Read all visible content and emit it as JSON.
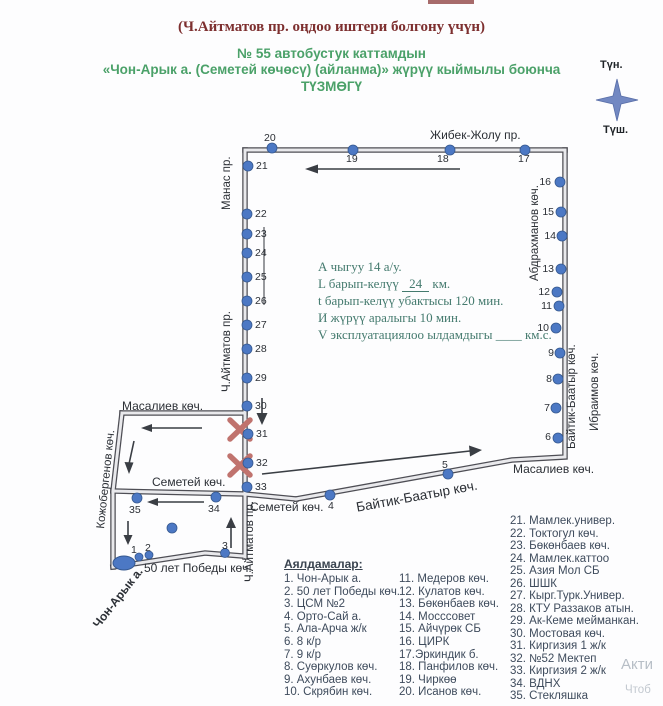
{
  "header": {
    "line1": "(Ч.Айтматов пр. оңдоо иштери болгону үчүн)",
    "line2": "№ 55  автобустук каттамдын",
    "line3": "«Чон-Арык а. (Семетей көчөсү) (айланма)»  жүрүү кыймылы боюнча",
    "line4": "ТҮЗМӨГҮ"
  },
  "compass": {
    "north": "Түн.",
    "south": "Түш."
  },
  "info": {
    "line1": "А чыгуу 14 а/у.",
    "line2_prefix": "L барып-келүү",
    "line2_value": "24",
    "line2_suffix": "км.",
    "line3": "t барып-келүү убактысы 120 мин.",
    "line4": "И жүрүү аралыгы  10  мин.",
    "line5_prefix": "V эксплуатациялоо ылдамдыгы",
    "line5_blank": "____",
    "line5_suffix": "км.с."
  },
  "streets": {
    "zhibek_zholu": "Жибек-Жолу пр.",
    "manas": "Манас пр.",
    "aitmatov": "Ч.Айтматов пр.",
    "abdrakhmanov": "Абдрахманов көч.",
    "baitik_baatyr": "Байтик-Баатыр көч.",
    "ibraimov": "Ибраимов көч.",
    "masaliev": "Масалиев  көч.",
    "kozhobergenov": "Кожобергенов көч.",
    "semetei": "Семетей  көч.",
    "pobedy": "50 лет Победы көч.",
    "chon_aryk": "Чон-Арык а."
  },
  "stop_numbers": [
    "1",
    "2",
    "3",
    "4",
    "5",
    "6",
    "7",
    "8",
    "9",
    "10",
    "11",
    "12",
    "13",
    "14",
    "15",
    "16",
    "17",
    "18",
    "19",
    "20",
    "21",
    "22",
    "23",
    "24",
    "25",
    "26",
    "27",
    "28",
    "29",
    "30",
    "31",
    "32",
    "33",
    "34",
    "35"
  ],
  "legend": {
    "title": "Аялдамалар:",
    "col1": [
      "1. Чон-Арык а.",
      "2. 50 лет Победы көч.",
      "3. ЦСМ №2",
      "4. Орто-Сай а.",
      "5. Ала-Арча ж/к",
      "6. 8 к/р",
      "7. 9 к/р",
      "8. Суөркулов көч.",
      "9. Ахунбаев көч.",
      "10. Скрябин көч."
    ],
    "col2": [
      "11. Медеров көч.",
      "12. Кулатов көч.",
      "13. Бөкөнбаев көч.",
      "14. Мосссовет",
      "15. Айчүрөк СБ",
      "16. ЦИРК",
      "17.Эркиндик б.",
      "18. Панфилов көч.",
      "19. Чиркөө",
      "20. Исанов көч."
    ],
    "col3": [
      "21. Мамлек.универ.",
      "22. Токтогул көч.",
      "23. Бөкөнбаев көч.",
      "24. Мамлек.каттоо",
      "25. Азия Мол СБ",
      "26. ШШК",
      "27. Кырг.Турк.Универ.",
      "28. КТУ Раззаков атын.",
      "29. Ак-Кеме мейманкан.",
      "30. Мостовая көч.",
      "31. Киргизия 1 ж/к",
      "32. №52 Мектеп",
      "33. Киргизия 2 ж/к",
      "34. ВДНХ",
      "35. Стекляшка"
    ]
  },
  "watermark": {
    "line1": "Акти",
    "line2": "Чтоб"
  },
  "colors": {
    "title_red": "#7d2f2f",
    "title_green": "#4ba169",
    "info_teal": "#447a6e",
    "stop_blue": "#4c78c4",
    "closure_red": "#c0736e",
    "road_dark": "#4e4e55"
  }
}
